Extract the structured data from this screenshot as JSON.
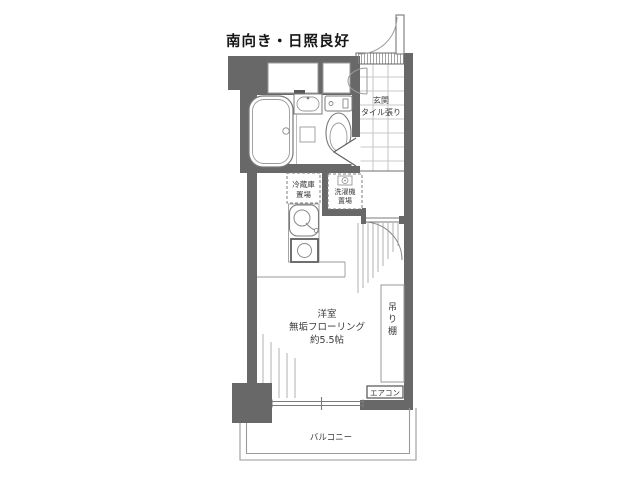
{
  "title": "南向き・日照良好",
  "plan": {
    "entrance": {
      "name": "玄関",
      "floor": "タイル張り"
    },
    "fridge": {
      "line1": "冷蔵庫",
      "line2": "置場"
    },
    "washer": {
      "line1": "洗濯機",
      "line2": "置場"
    },
    "room": {
      "line1": "洋室",
      "line2": "無垢フローリング",
      "line3": "約5.5帖"
    },
    "shelf": {
      "label": "吊り棚",
      "chars": [
        "吊",
        "り",
        "棚"
      ]
    },
    "aircon": {
      "label": "エアコン"
    },
    "balcony": {
      "label": "バルコニー"
    }
  },
  "colors": {
    "wall": "#686868",
    "fixture_line": "#808080",
    "light_line": "#aaaaaa",
    "text": "#3a3a3a"
  }
}
